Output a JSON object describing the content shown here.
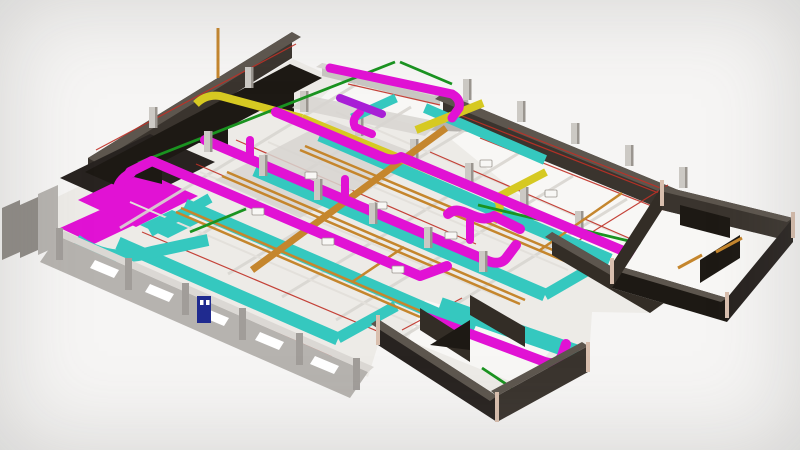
{
  "meta": {
    "type": "3d-bim-model-rendering",
    "view": "isometric",
    "subject": "building floor plate with exposed MEP (mechanical, electrical, plumbing) systems",
    "visible_text": ""
  },
  "colors": {
    "background": "#f6f5f4",
    "floor": "#edebe7",
    "floor_bright": "#f8f7f5",
    "slab_gray": "#d8d5d1",
    "beam_gray": "#d9d6d1",
    "pipe_white": "#e3e0db",
    "wall_dark": "#3a342e",
    "wall_dark_top": "#5d564e",
    "wall_darker": "#282320",
    "wall_brown": "#332d26",
    "wall_black": "#1d1914",
    "wall_light": "#b6b3af",
    "wall_light_top": "#dbd8d4",
    "wall_light_post": "#a19d99",
    "wall_gray": "#8f8b86",
    "wall_gray_top": "#b5b1ac",
    "ramp_gray": "#c9c6c2",
    "column_face": "#ccc9c4",
    "column_side": "#9a958f",
    "tan_post": "#d9bfae",
    "navy": "#1f2a8f",
    "white": "#ffffff",
    "red": "#c03026",
    "green": "#1a9320",
    "orange": "#c5862d",
    "yellow": "#d6c922",
    "cyan": "#35c8bf",
    "magenta": "#e112d4",
    "purple": "#a81fd6"
  },
  "systems": [
    {
      "name": "magenta-ductwork",
      "color": "#e112d4"
    },
    {
      "name": "cyan-ductwork",
      "color": "#35c8bf"
    },
    {
      "name": "orange-piping",
      "color": "#c5862d"
    },
    {
      "name": "yellow-ductwork",
      "color": "#d6c922"
    },
    {
      "name": "violet-duct-segment",
      "color": "#a81fd6"
    },
    {
      "name": "green-piping",
      "color": "#1a9320"
    },
    {
      "name": "red-sprinkler-lines",
      "color": "#c03026"
    }
  ]
}
